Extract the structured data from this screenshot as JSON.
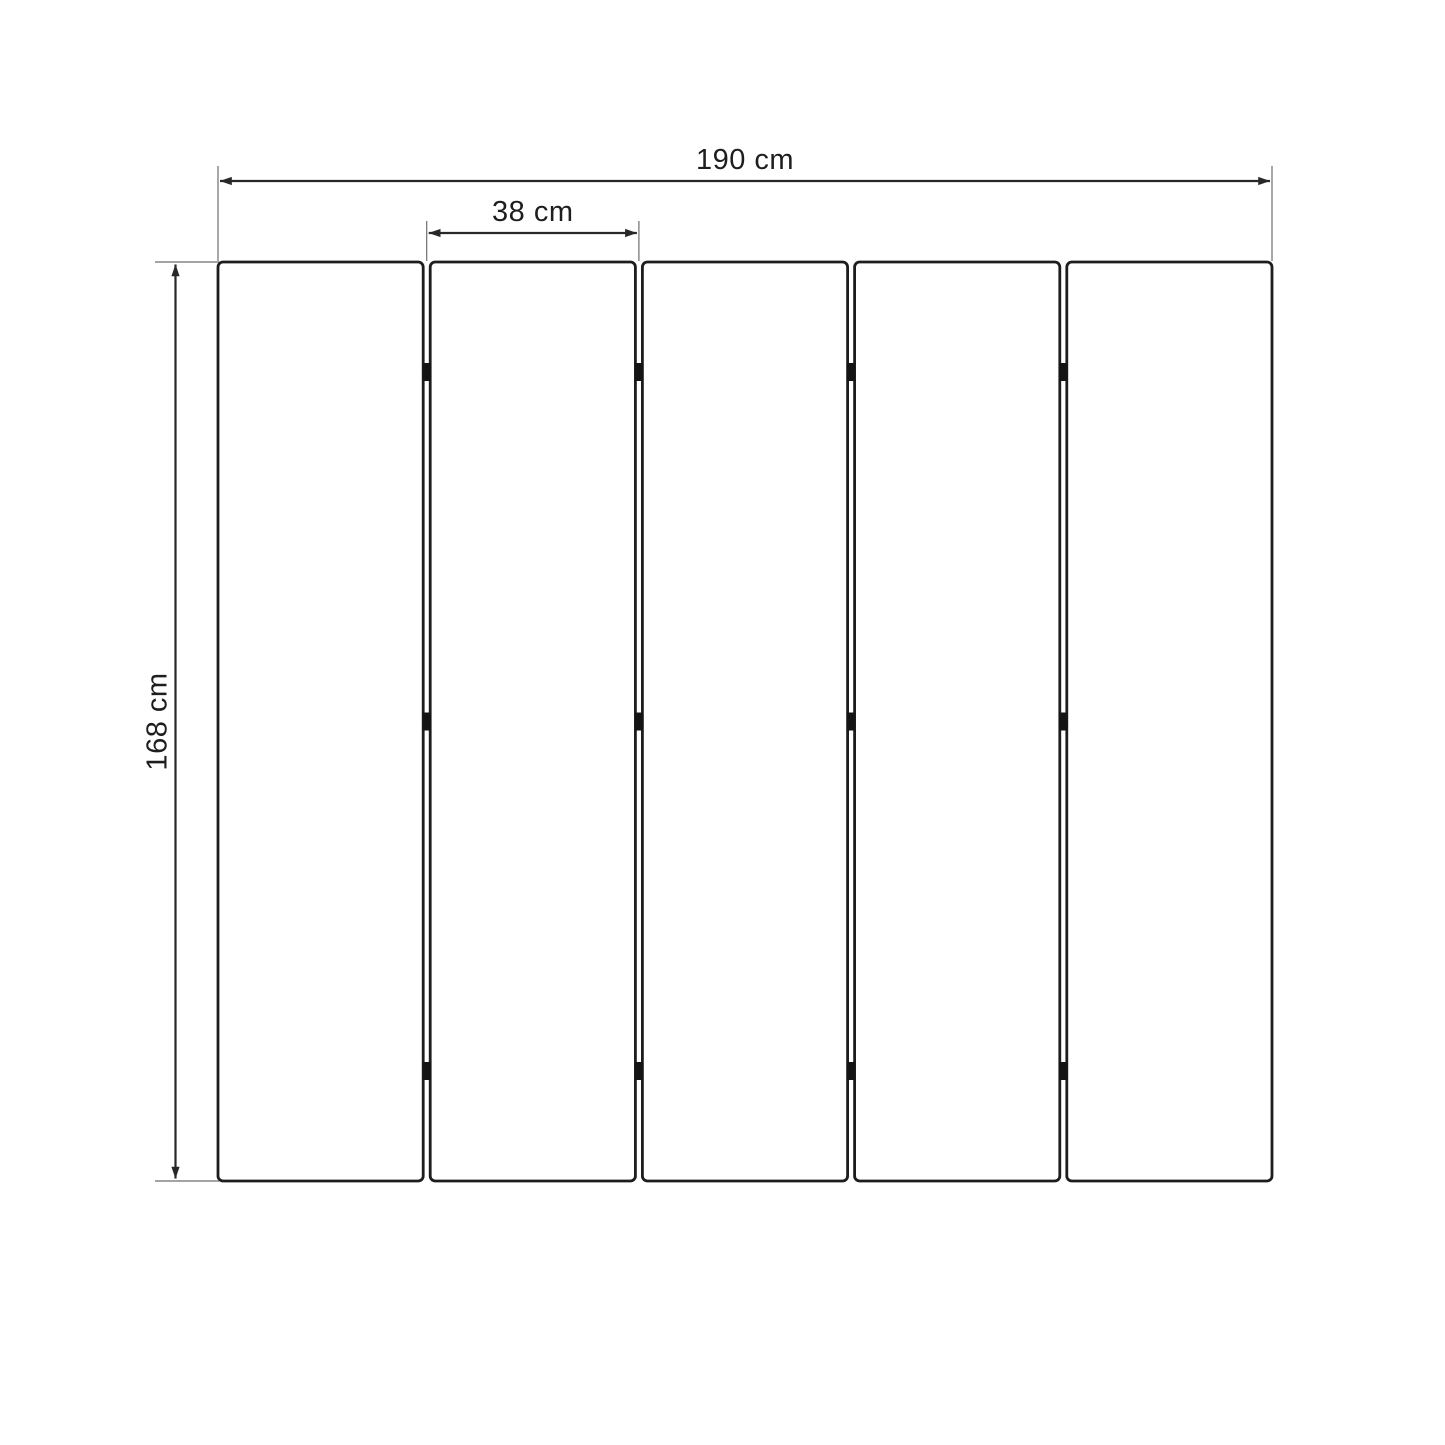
{
  "diagram": {
    "type": "dimension-drawing",
    "subject": "five-panel folding screen, front view",
    "panel_count": 5,
    "hinge_rows": 3,
    "hinge_columns": 4,
    "colors": {
      "background": "#ffffff",
      "panel_stroke": "#1d1d1d",
      "dimension_line": "#282828",
      "extension_line": "#6e6e6e",
      "hinge": "#141414",
      "label_text": "#1e1e1e"
    },
    "dimensions": {
      "total_width": {
        "label": "190 cm"
      },
      "panel_width": {
        "label": "38 cm"
      },
      "height": {
        "label": "168 cm"
      }
    }
  }
}
